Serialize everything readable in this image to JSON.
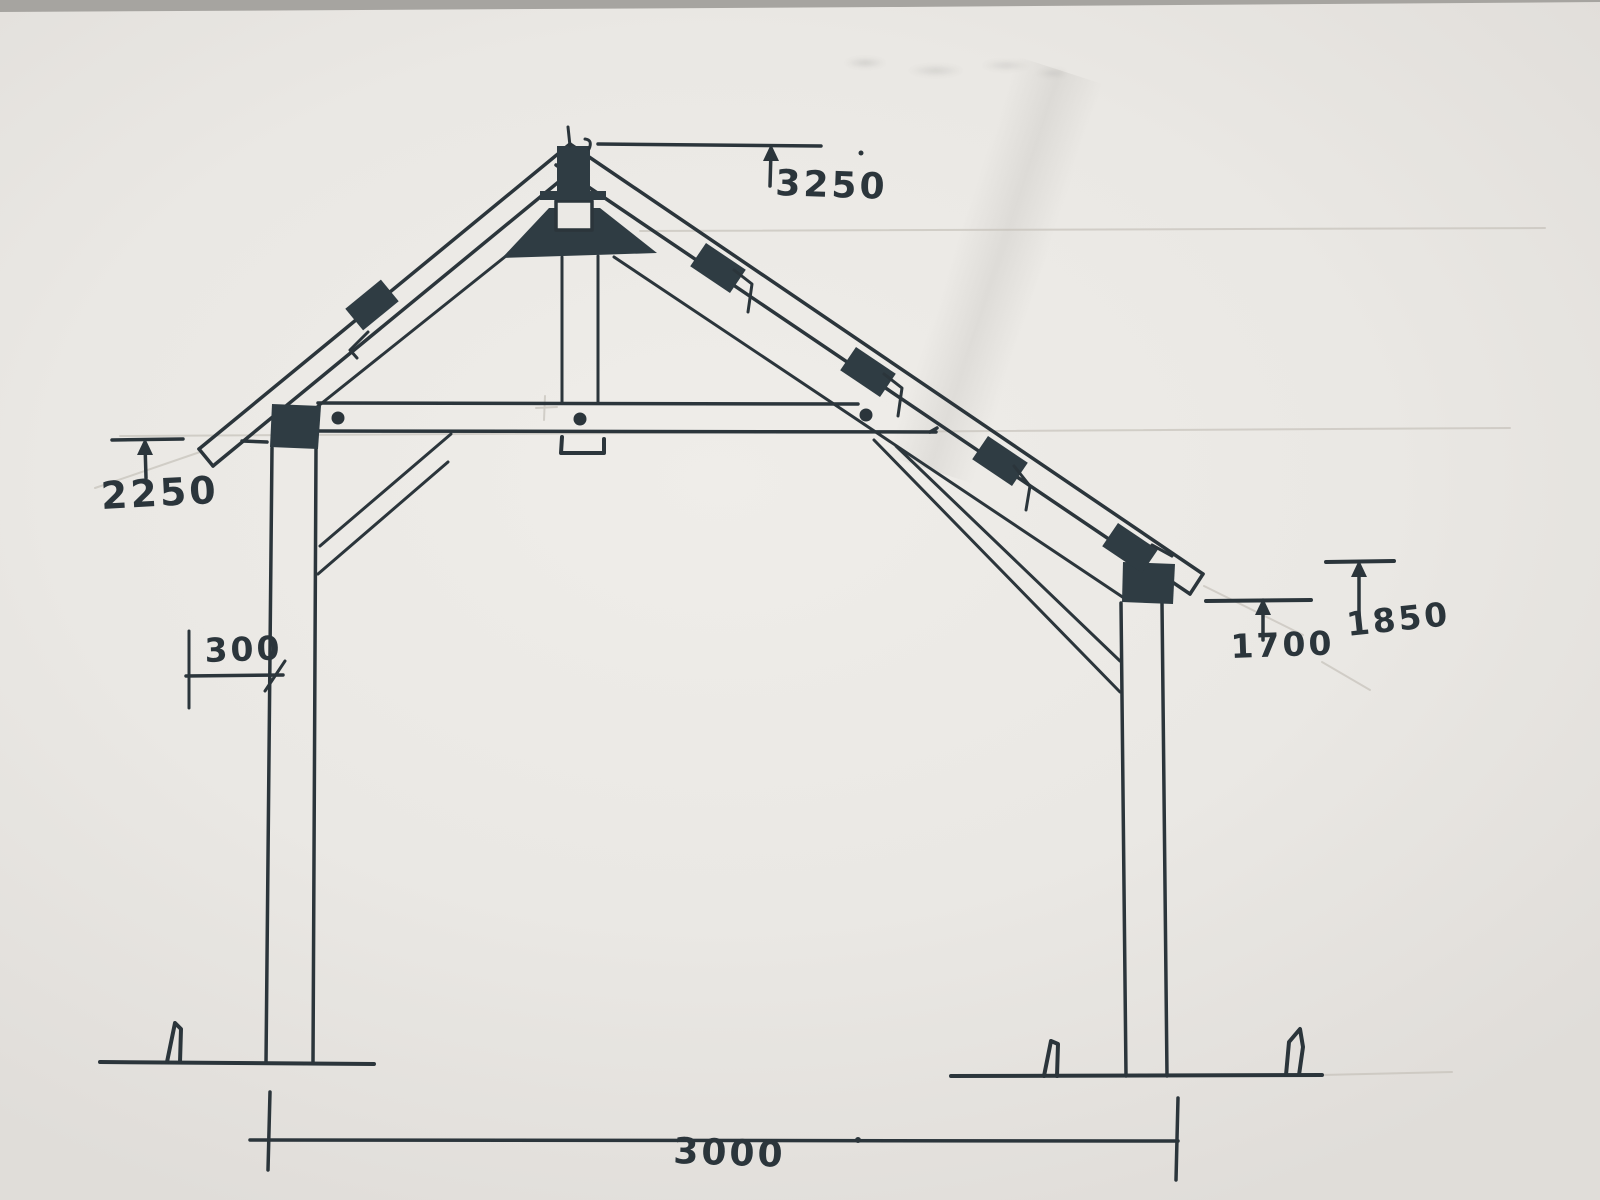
{
  "sketch": {
    "description": "hand-drawn timber gazebo truss section",
    "dimension_labels": {
      "apex_height": "3250",
      "left_eave_height": "2250",
      "post_inset": "300",
      "right_post_height": "1700",
      "right_eave_height": "1850",
      "span": "3000"
    }
  },
  "colors": {
    "ink": "#2b353b",
    "block_fill": "#2f3c43",
    "paper": "#ebe9e5",
    "pencil": "#c0bcb4",
    "photo_edge": "#a6a4a0"
  }
}
